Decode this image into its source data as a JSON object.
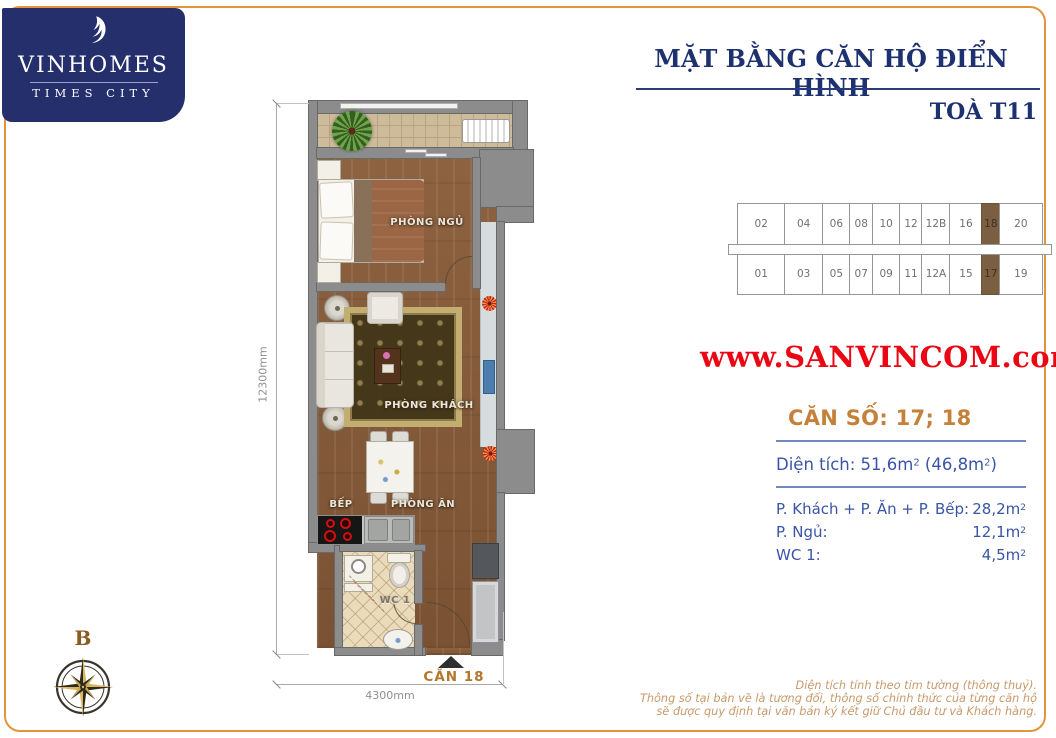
{
  "logo": {
    "brand": "VINHOMES",
    "subtitle": "TIMES CITY"
  },
  "header": {
    "title": "MẶT BẰNG CĂN HỘ ĐIỂN HÌNH",
    "tower": "TOÀ T11"
  },
  "watermark": "www.SANVINCOM.com",
  "key_plan": {
    "top_row": [
      "02",
      "04",
      "06",
      "08",
      "10",
      "12",
      "12B",
      "16",
      "18",
      "20"
    ],
    "bottom_row": [
      "01",
      "03",
      "05",
      "07",
      "09",
      "11",
      "12A",
      "15",
      "17",
      "19"
    ],
    "highlighted": [
      "17",
      "18"
    ],
    "highlight_color": "#7c5f41"
  },
  "unit_info": {
    "heading": "CĂN SỐ: 17; 18",
    "area_line": {
      "label": "Diện tích: ",
      "main": "51,6m",
      "main_sup": "2",
      "paren": " (46,8m",
      "paren_sup": "2",
      "close": ")"
    },
    "rows": [
      {
        "label": "P. Khách + P. Ăn + P. Bếp:",
        "value": "28,2m",
        "sup": "2"
      },
      {
        "label": "P. Ngủ:",
        "value": "12,1m",
        "sup": "2"
      },
      {
        "label": "WC 1:",
        "value": "4,5m",
        "sup": "2"
      }
    ]
  },
  "floor_plan": {
    "rooms": {
      "bedroom": "PHÒNG NGỦ",
      "living": "PHÒNG KHÁCH",
      "dining": "PHÒNG ĂN",
      "kitchen": "BẾP",
      "wc": "WC 1"
    },
    "unit_label": "CĂN 18",
    "dim_vertical": "12300mm",
    "dim_horizontal": "4300mm",
    "compass_label": "B"
  },
  "disclaimer": {
    "line1": "Diện tích tính theo tim tường (thông thuỷ).",
    "line2": "Thông số tại bản vẽ là tương đối, thông số chính thức của từng căn hộ",
    "line3": "sẽ được quy định tại văn bản ký kết giữ Chủ đầu tư và Khách hàng."
  },
  "colors": {
    "brand_navy": "#252f6b",
    "title_blue": "#1d3070",
    "frame_orange": "#e2943b",
    "accent_orange": "#c5813a",
    "watermark_red": "#ea0613",
    "detail_blue": "#3a55a6",
    "highlight_brown": "#7c5f41"
  }
}
